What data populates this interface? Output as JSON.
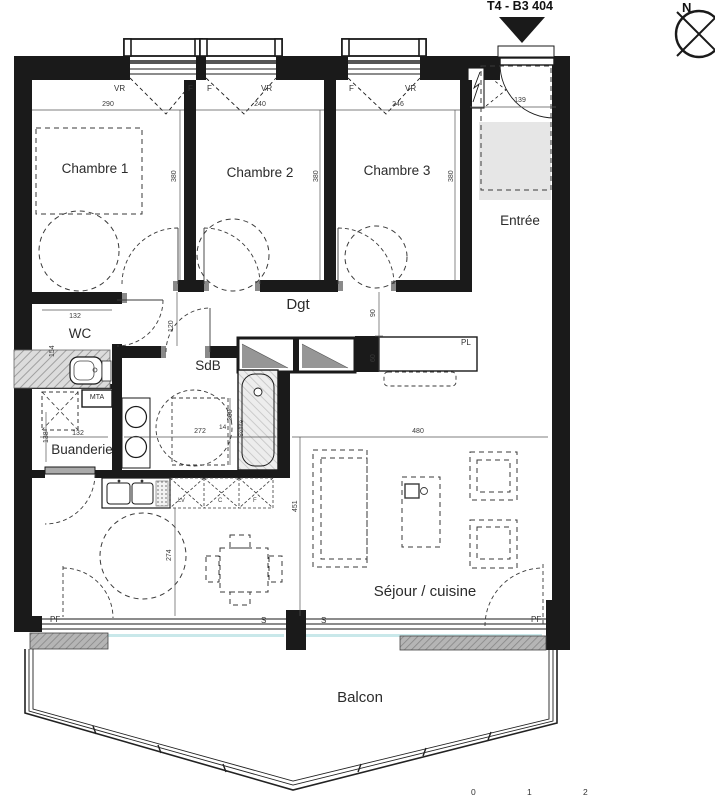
{
  "header": {
    "title": "T4 - B3 404"
  },
  "compass": {
    "north": "N"
  },
  "rooms": {
    "chambre1": {
      "name": "Chambre 1",
      "width": "290",
      "depth": "380"
    },
    "chambre2": {
      "name": "Chambre 2",
      "width": "240",
      "depth": "380"
    },
    "chambre3": {
      "name": "Chambre 3",
      "width": "246",
      "depth": "380"
    },
    "entree": {
      "name": "Entrée",
      "door_width": "139"
    },
    "dgt": {
      "name": "Dgt",
      "width": "120",
      "dim_a": "90",
      "dim_b": "60"
    },
    "wc": {
      "name": "WC",
      "width": "132",
      "depth": "154"
    },
    "sdb": {
      "name": "SdB",
      "width": "272",
      "depth": "200",
      "tub_offset": "14",
      "soffit": "Soffite"
    },
    "buanderie": {
      "name": "Buanderie",
      "width": "132",
      "depth": "138"
    },
    "sejour": {
      "name": "Séjour / cuisine",
      "width": "480",
      "depth": "451",
      "kitchen_run": "274"
    },
    "balcon": {
      "name": "Balcon"
    }
  },
  "openings": {
    "vr": "VR",
    "f": "F",
    "pf": "PF",
    "s": "S",
    "pl": "PL",
    "mta": "MTA"
  },
  "appliances": {
    "lv": "LV",
    "c": "C",
    "f": "F"
  },
  "scale_bar": {
    "t0": "0",
    "t1": "1",
    "t2": "2"
  }
}
